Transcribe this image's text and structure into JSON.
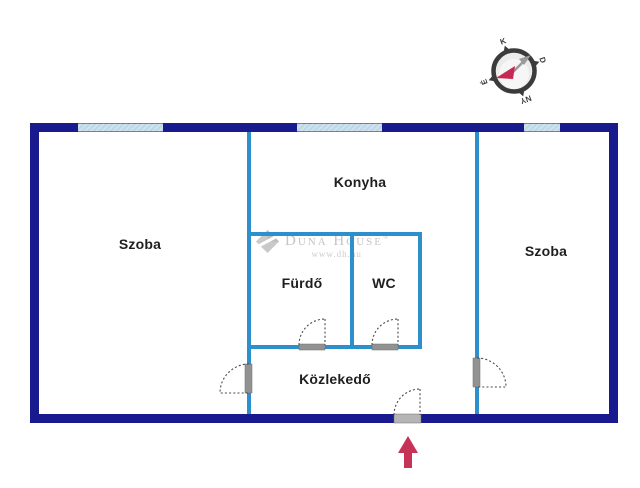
{
  "floorplan": {
    "rooms": [
      {
        "id": "szoba-left",
        "label": "Szoba"
      },
      {
        "id": "konyha",
        "label": "Konyha"
      },
      {
        "id": "furdo",
        "label": "Fürdő"
      },
      {
        "id": "wc",
        "label": "WC"
      },
      {
        "id": "szoba-right",
        "label": "Szoba"
      },
      {
        "id": "kozlekedo",
        "label": "Közlekedő"
      }
    ],
    "features": {
      "windows": 3,
      "doors": 5,
      "entrance_marker": "up-arrow"
    },
    "colors": {
      "outer_wall": "#1a1a8f",
      "inner_wall": "#2d8fcb",
      "window": "#bdd6e8",
      "door_opening": "#929292",
      "door_arc": "#4a4a4a",
      "entrance_arrow": "#c73357",
      "label_text": "#1f1f1f",
      "watermark_gray": "#c4c4c4"
    }
  },
  "compass": {
    "north": "É",
    "east": "K",
    "south": "D",
    "west": "NY"
  },
  "watermark": {
    "brand": "Duna House",
    "registered": "®",
    "url": "www.dh.hu"
  }
}
